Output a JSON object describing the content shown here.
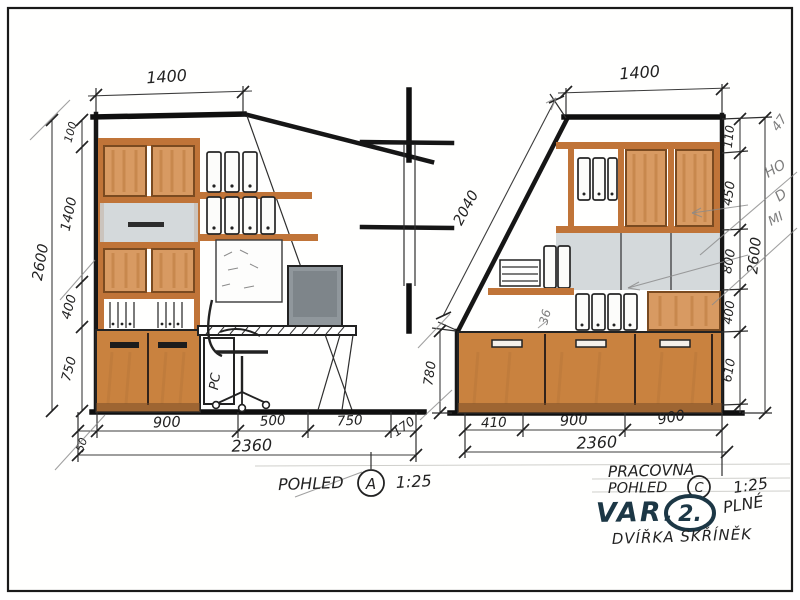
{
  "view_a": {
    "top_width": "1400",
    "left": {
      "overall": "2600",
      "segments": [
        "100",
        "1400",
        "400",
        "750"
      ]
    },
    "bottom": {
      "segments": [
        "50",
        "900",
        "500",
        "750",
        "170"
      ],
      "total": "2360"
    },
    "caption": {
      "label": "POHLED",
      "letter": "A",
      "scale": "1:25"
    },
    "pc": "PC"
  },
  "view_c": {
    "top_width": "1400",
    "slope": "2040",
    "right": {
      "overall": "2600",
      "segments": [
        "110",
        "450",
        "800",
        "400",
        "610"
      ]
    },
    "left_height": "780",
    "bottom": {
      "segments": [
        "410",
        "900",
        "900"
      ],
      "total": "2360"
    },
    "note": "36"
  },
  "margin_notes": [
    "47",
    "HO",
    "D",
    "MI"
  ],
  "title_block": {
    "project": "PRACOVNA",
    "view_label": "POHLED",
    "view_letter": "C",
    "scale": "1:25",
    "variant_label": "VAR.",
    "variant_number": "2.",
    "variant_note": "PLNÉ",
    "subtitle": "DVÍŘKA SKŘÍNĚK"
  },
  "colors": {
    "ink": "#1f1f1f",
    "wood": "#c9823f",
    "wood_light": "#d89a62",
    "frame_orange": "#c07438",
    "gray_marker": "#c9cfd2",
    "pencil": "#8a8a8a",
    "marker_navy": "#1c3745"
  }
}
